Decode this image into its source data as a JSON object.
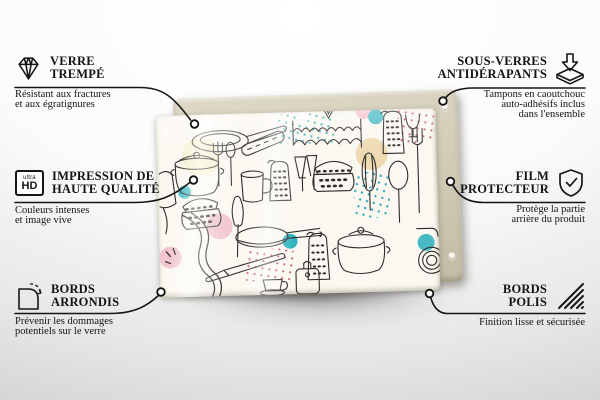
{
  "product": {
    "name": "glass-board-with-kitchen-pattern",
    "artwork": "kitchen-utensils-doodle-pattern",
    "palette": {
      "glass_bg": "#fbf8f1",
      "sketch_line": "#2e2c2a",
      "teal": "#2fb3bf",
      "pink": "#f0bdc9",
      "pale_yellow": "#f5f1cd",
      "tan": "#ebd3a6",
      "dot_red": "#c45d72",
      "dot_teal": "#35aab6",
      "backing_board": "#d1cbb5"
    }
  },
  "callouts": [
    {
      "id": "verre-trempe",
      "side": "left",
      "icon": "diamond-icon",
      "title_lines": [
        "VERRE",
        "TREMPÉ"
      ],
      "description_lines": [
        "Résistant aux fractures",
        "et aux égratignures"
      ]
    },
    {
      "id": "impression-haute-qualite",
      "side": "left",
      "icon": "ultra-hd-icon",
      "icon_text_small": "ultra",
      "icon_text_big": "HD",
      "title_lines": [
        "IMPRESSION DE",
        "HAUTE QUALITÉ"
      ],
      "description_lines": [
        "Couleurs intenses",
        "et image vive"
      ]
    },
    {
      "id": "bords-arrondis",
      "side": "left",
      "icon": "rounded-corner-icon",
      "title_lines": [
        "BORDS",
        "ARRONDIS"
      ],
      "description_lines": [
        "Prévenir les dommages",
        "potentiels sur le verre"
      ]
    },
    {
      "id": "sous-verres-antiderapants",
      "side": "right",
      "icon": "anti-slip-pads-icon",
      "title_lines": [
        "SOUS-VERRES",
        "ANTIDÉRAPANTS"
      ],
      "description_lines": [
        "Tampons en caoutchouc",
        "auto-adhésifs inclus",
        "dans l'ensemble"
      ]
    },
    {
      "id": "film-protecteur",
      "side": "right",
      "icon": "shield-check-icon",
      "title_lines": [
        "FILM",
        "PROTECTEUR"
      ],
      "description_lines": [
        "Protège la partie",
        "arrière du produit"
      ]
    },
    {
      "id": "bords-polis",
      "side": "right",
      "icon": "polished-edges-icon",
      "title_lines": [
        "BORDS",
        "POLIS"
      ],
      "description_lines": [
        "Finition lisse et sécurisée"
      ]
    }
  ]
}
